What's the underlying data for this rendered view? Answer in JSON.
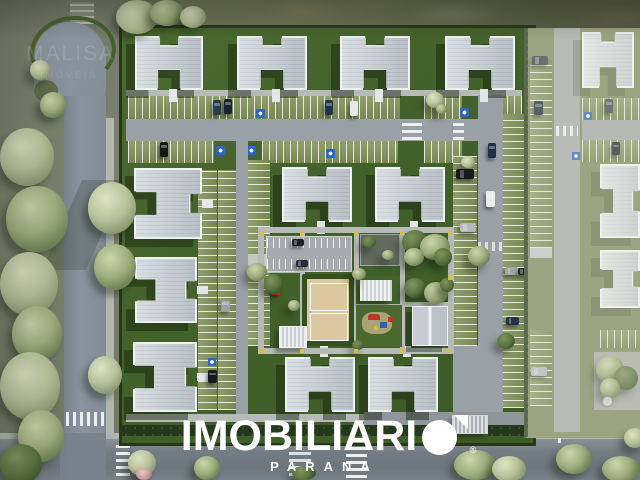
{
  "scene_type": "aerial 3d architectural render of a residential condominium master plan",
  "watermark": {
    "wordmark_prefix": "IMOBILIARI",
    "logo_mark": "white-disc-with-corner-triangle-as-letter-O",
    "registered": "®",
    "subtitle": "PARANA",
    "color": "#ffffff"
  },
  "corner_watermark": {
    "line1": "MALISA",
    "line2": "IMÓVEIS"
  },
  "palette": {
    "lawn": "#46652e",
    "lawn_shadow": "#2a4420",
    "roof": "#c9d0d5",
    "roof_edge": "#eef1f2",
    "internal_road": "#9aa1a6",
    "public_road": "#747c84",
    "parking_grass_pavers": "#81925a",
    "hedge": "#24391b",
    "sand_court": "#dcc9a2",
    "accessibility_blue": "#2f66c4",
    "marker_yellow": "#dcc23c",
    "playground_red": "#c03527",
    "playground_blue": "#2d5fb5",
    "tree_green": "#73875a",
    "outside_grass": "#767d6a",
    "haze_overlay": "#ebe7d8"
  }
}
